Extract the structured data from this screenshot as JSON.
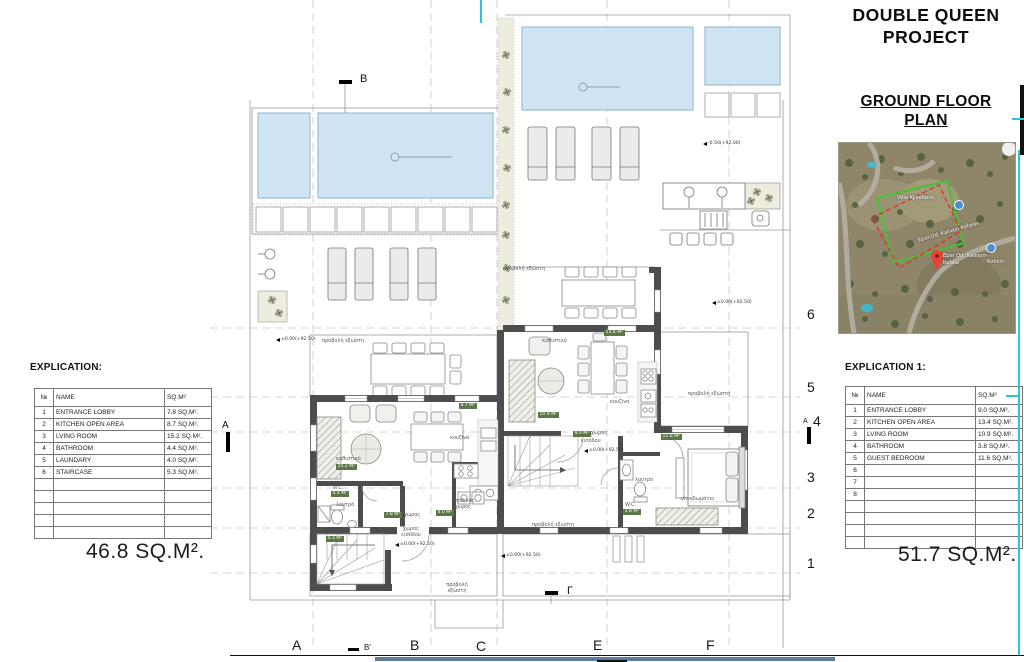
{
  "title_block": {
    "project": "DOUBLE QUEEN PROJECT",
    "drawing": "GROUND FLOOR PLAN"
  },
  "left_explication": {
    "heading": "EXPLICATION:",
    "columns": {
      "num": "№",
      "name": "NAME",
      "area": "SQ.M²"
    },
    "rows": [
      {
        "num": "1",
        "name": "ENTRANCE LOBBY",
        "area": "7.8 SQ.M²."
      },
      {
        "num": "2",
        "name": "KITCHEN OPEN AREA",
        "area": "8.7 SQ.M²."
      },
      {
        "num": "3",
        "name": "LVING ROOM",
        "area": "15.2 SQ.M²."
      },
      {
        "num": "4",
        "name": "BATHROOM",
        "area": "4.4  SQ.M²."
      },
      {
        "num": "5",
        "name": "LAUNDARY",
        "area": "4.0 SQ.M²."
      },
      {
        "num": "6",
        "name": "STAIRCASE",
        "area": "5.3 SQ.M²."
      }
    ],
    "total": "46.8 SQ.M²."
  },
  "right_explication": {
    "heading": "EXPLICATION  1:",
    "columns": {
      "num": "№",
      "name": "NAME",
      "area": "SQ.M²"
    },
    "rows": [
      {
        "num": "1",
        "name": "ENTRANCE LOBBY",
        "area": "9.0 SQ.M²."
      },
      {
        "num": "2",
        "name": "KITCHEN OPEN AREA",
        "area": "13.4 SQ.M²."
      },
      {
        "num": "3",
        "name": "LVING ROOM",
        "area": "10.9 SQ.M²."
      },
      {
        "num": "4",
        "name": "BATHROOM",
        "area": "3.8  SQ.M²."
      },
      {
        "num": "5",
        "name": "GUEST BEDROOM",
        "area": "11.6 SQ.M²."
      },
      {
        "num": "6",
        "name": "",
        "area": ""
      },
      {
        "num": "7",
        "name": "",
        "area": ""
      },
      {
        "num": "8",
        "name": "",
        "area": ""
      }
    ],
    "total": "51.7 SQ.M²."
  },
  "grid": {
    "letters": [
      "A",
      "B'",
      "B",
      "C",
      "E",
      "F"
    ],
    "numbers": [
      "6",
      "5",
      "4",
      "3",
      "2",
      "1"
    ]
  },
  "sections": {
    "top": "B",
    "bottom": "Γ",
    "left": "A",
    "right": "A"
  },
  "levels": {
    "pool": "-0.50(+92.00)",
    "zero": "±0.00(+92.50)"
  },
  "rooms": {
    "balcony": "προβολή εξώστη",
    "living": "καθιστικό",
    "kitchen": "κουζίνα",
    "bath": "λουτρό",
    "wc": "W.C.",
    "hall": "χώρος εισόδου",
    "hall1": "χώρος",
    "hall2": "εισόδου",
    "storage": "αποθ/κός χώρος",
    "bedroom": "υπνοδωμάτιο"
  },
  "badges": {
    "l_living": "15.2 M²",
    "l_kitchen": "8.7 M²",
    "l_wc": "4.4 M²",
    "l_hall": "7.8 M²",
    "l_storage": "4.0 M²",
    "l_stairs": "5.3 M²",
    "r_kitchen": "13.4 M²",
    "r_living": "10.9 M²",
    "r_hall": "9.0 M²",
    "r_bedroom": "11.6 M²",
    "r_wc": "3.8 M²"
  },
  "map": {
    "villa": "Villa Kyliebeck",
    "road": "Epar.Od. Kalivon-Kefalas",
    "pin_line1": "Epar.Od. Kalivon-",
    "pin_line2": "Kefala",
    "poi": "Kokkin"
  },
  "colors": {
    "pool": "#cfe5f3",
    "wall": "#4d4d4d",
    "badge_green": "#5d7847",
    "cyan_accent": "#2cc6d8",
    "steel_bar": "#5c7d99"
  }
}
